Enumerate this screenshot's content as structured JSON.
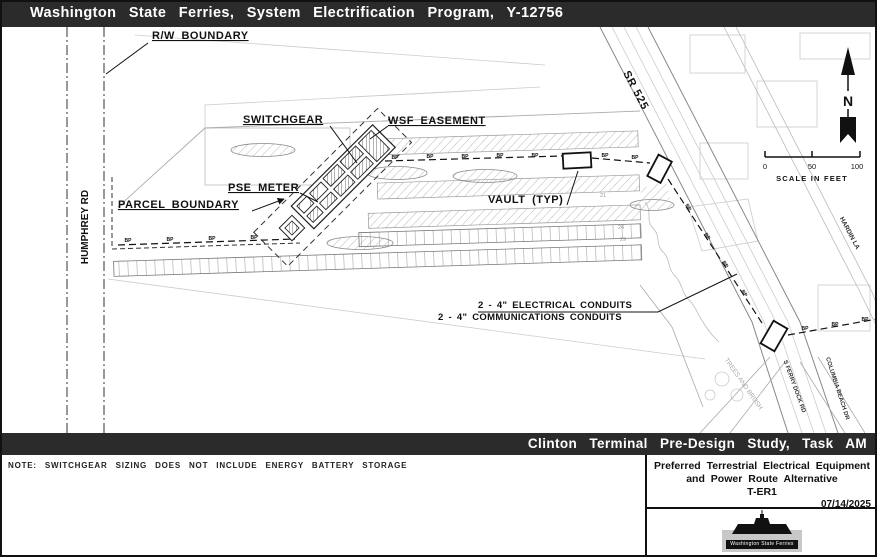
{
  "header": {
    "title": "Washington State Ferries, System Electrification Program, Y-12756"
  },
  "footer_banner": {
    "title": "Clinton Terminal Pre-Design Study, Task AM"
  },
  "note": {
    "text": "NOTE: SWITCHGEAR SIZING DOES NOT INCLUDE ENERGY BATTERY STORAGE"
  },
  "title_block": {
    "line1": "Preferred Terrestrial Electrical Equipment",
    "line2": "and Power Route Alternative",
    "line3": "T-ER1",
    "date": "07/14/2025",
    "logo_text": "Washington State Ferries"
  },
  "map": {
    "labels": {
      "rw_boundary": "R/W BOUNDARY",
      "switchgear": "SWITCHGEAR",
      "wsf_easement": "WSF EASEMENT",
      "pse_meter": "PSE METER",
      "parcel_boundary": "PARCEL BOUNDARY",
      "vault_typ": "VAULT (TYP)",
      "electrical_conduits": "2 - 4\" ELECTRICAL CONDUITS",
      "communications_conduits": "2 - 4\" COMMUNICATIONS CONDUITS",
      "humphrey_rd": "HUMPHREY RD",
      "sr_525": "SR 525",
      "hardin_la": "HARDIN LA",
      "s_ferry_dock_rd": "S FERRY DOCK RD",
      "columbia_beach_dr": "COLUMBIA BEACH DR",
      "trees": "TREES AND BRUSH",
      "bp_marker": "BP",
      "north": "N"
    },
    "scale": {
      "start": "0",
      "mid": "50",
      "end": "100",
      "caption": "SCALE IN FEET"
    },
    "stall_numbers": [
      "21",
      "24",
      "29"
    ]
  },
  "colors": {
    "banner_bg": "#2b2b2b",
    "banner_text": "#ffffff",
    "line_dark": "#111111",
    "line_light": "#c8c8c8"
  }
}
